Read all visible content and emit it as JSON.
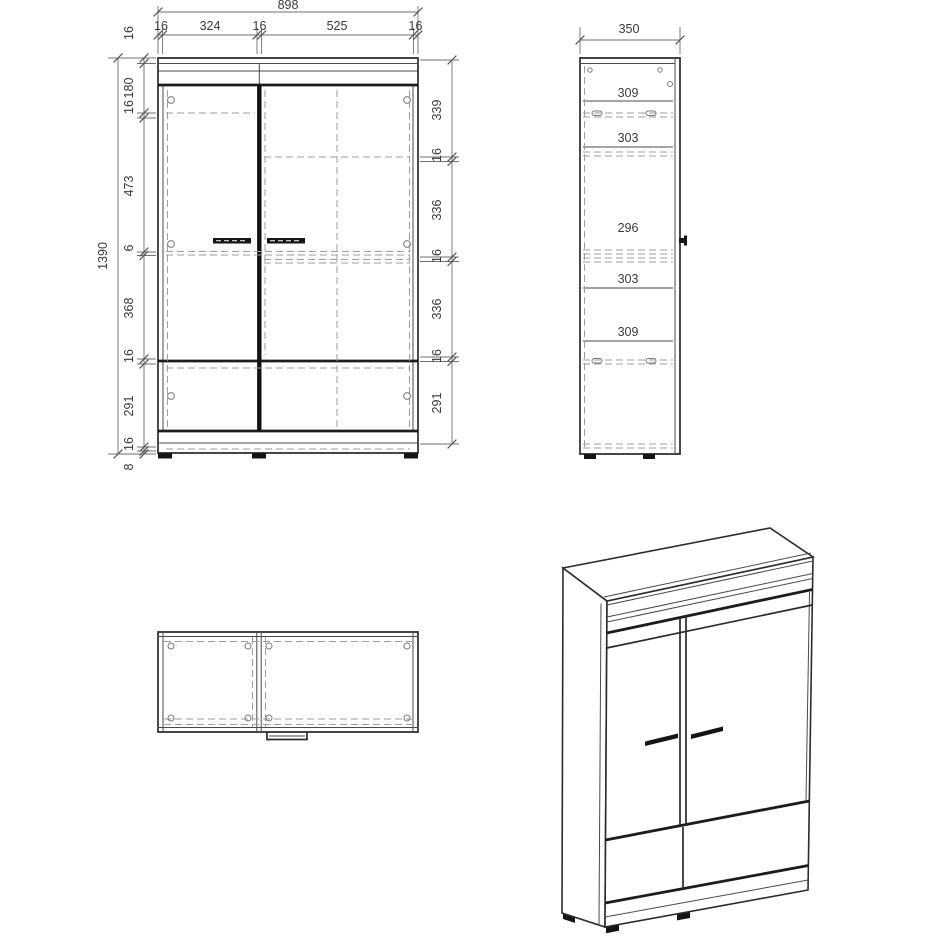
{
  "front_view": {
    "total_width": "898",
    "width_segments": [
      "16",
      "324",
      "16",
      "525",
      "16"
    ],
    "total_height": "1390",
    "left_height_segments": [
      "16",
      "180",
      "16",
      "473",
      "6",
      "368",
      "16",
      "291",
      "16",
      "8"
    ],
    "right_height_segments": [
      "339",
      "16",
      "336",
      "16",
      "336",
      "16",
      "291"
    ]
  },
  "side_view": {
    "total_depth": "350",
    "shelf_pitch_segments": [
      "309",
      "303",
      "296",
      "303",
      "309"
    ]
  },
  "colors": {
    "background": "#ffffff",
    "line_strong": "#1c1c1c",
    "line_medium": "#2b2b2b",
    "line_dashed": "#9e9e9e",
    "dimension_line": "#6f6f6f",
    "dimension_text": "#3a3a3a"
  }
}
